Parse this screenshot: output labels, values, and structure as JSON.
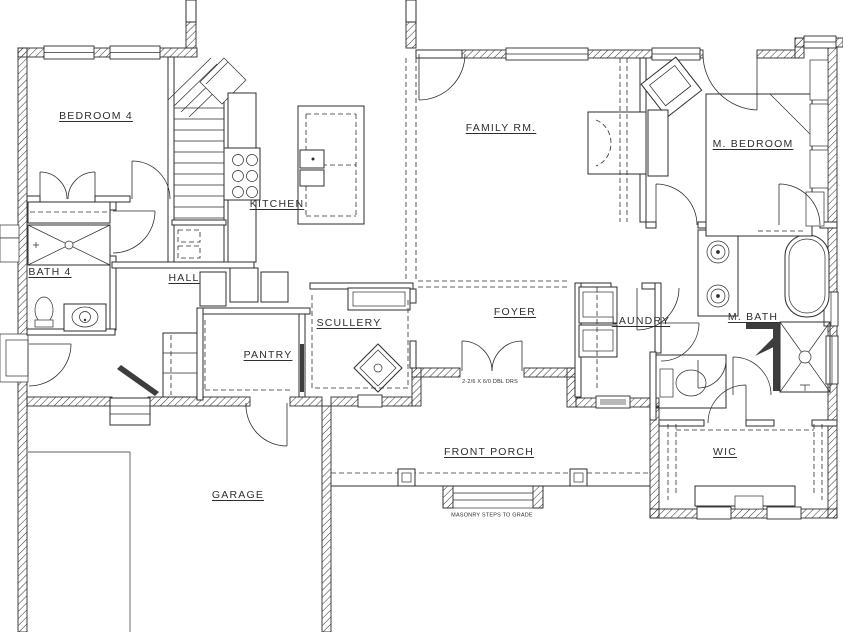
{
  "plan": {
    "paper_color": "#ffffff",
    "ink_color": "#2e2e2e",
    "rooms": {
      "dining": "DINING",
      "bedroom4": "BEDROOM 4",
      "kitchen": "KITCHEN",
      "family_room": "FAMILY RM.",
      "master_bedroom": "M. BEDROOM",
      "bath4": "BATH 4",
      "hall": "HALL",
      "scullery": "SCULLERY",
      "foyer": "FOYER",
      "laundry": "LAUNDRY",
      "master_bath": "M. BATH",
      "pantry": "PANTRY",
      "front_porch": "FRONT PORCH",
      "wic": "WIC",
      "garage": "GARAGE"
    },
    "annotations": {
      "front_doors": "2-2/6 X 6/0 DBL DRS",
      "masonry_steps": "MASONRY STEPS TO GRADE"
    }
  }
}
